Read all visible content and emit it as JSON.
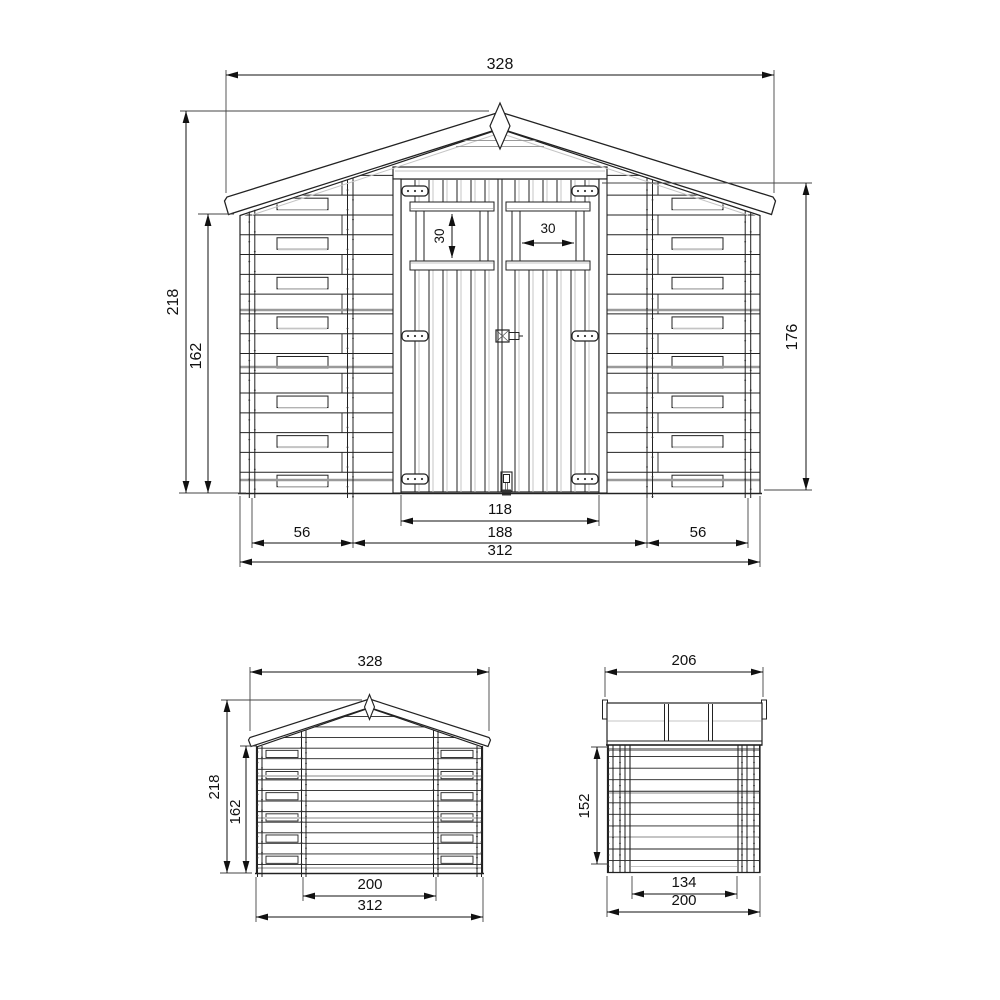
{
  "style": {
    "background": "#ffffff",
    "line_color": "#222222",
    "dim_color": "#111111",
    "shade_gray": "#9a9a9a",
    "light_gray": "#c4c4c4"
  },
  "views": {
    "front": {
      "dims": {
        "roof_width": "328",
        "total_height": "218",
        "eave_height": "162",
        "right_wall_height": "176",
        "window_height": "30",
        "window_width": "30",
        "door_opening_width": "118",
        "door_section_width": "188",
        "left_bay_width": "56",
        "right_bay_width": "56",
        "base_width": "312"
      }
    },
    "back": {
      "dims": {
        "roof_width": "328",
        "total_height": "218",
        "eave_height": "162",
        "floor_inner_width": "200",
        "base_width": "312"
      }
    },
    "side": {
      "dims": {
        "roof_depth": "206",
        "wall_height": "152",
        "floor_inner_depth": "134",
        "base_depth": "200"
      }
    }
  }
}
